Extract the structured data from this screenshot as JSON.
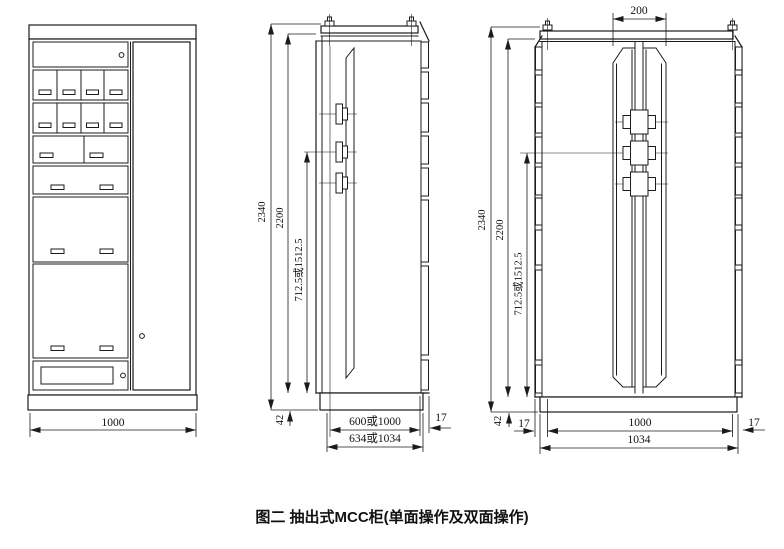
{
  "caption": "图二 抽出式MCC柜(单面操作及双面操作)",
  "colors": {
    "line": "#1b1b1b",
    "background": "#ffffff"
  },
  "front_view": {
    "title": "front elevation of drawout MCC cabinet",
    "dims": {
      "width": "1000"
    }
  },
  "side_view_single": {
    "title": "side view - single side operation",
    "dims": {
      "overall_height": "2340",
      "frame_height": "2200",
      "busbar_height": "712.5或1512.5",
      "base_height": "42",
      "depth_inner": "600或1000",
      "depth_overall": "634或1034",
      "panel_thickness": "17"
    }
  },
  "side_view_double": {
    "title": "side view - double side operation",
    "dims": {
      "center_gap": "200",
      "overall_height": "2340",
      "frame_height": "2200",
      "busbar_height": "712.5或1512.5",
      "base_height": "42",
      "panel_thickness_left": "17",
      "width_inner": "1000",
      "width_overall": "1034",
      "panel_thickness_right": "17"
    }
  }
}
